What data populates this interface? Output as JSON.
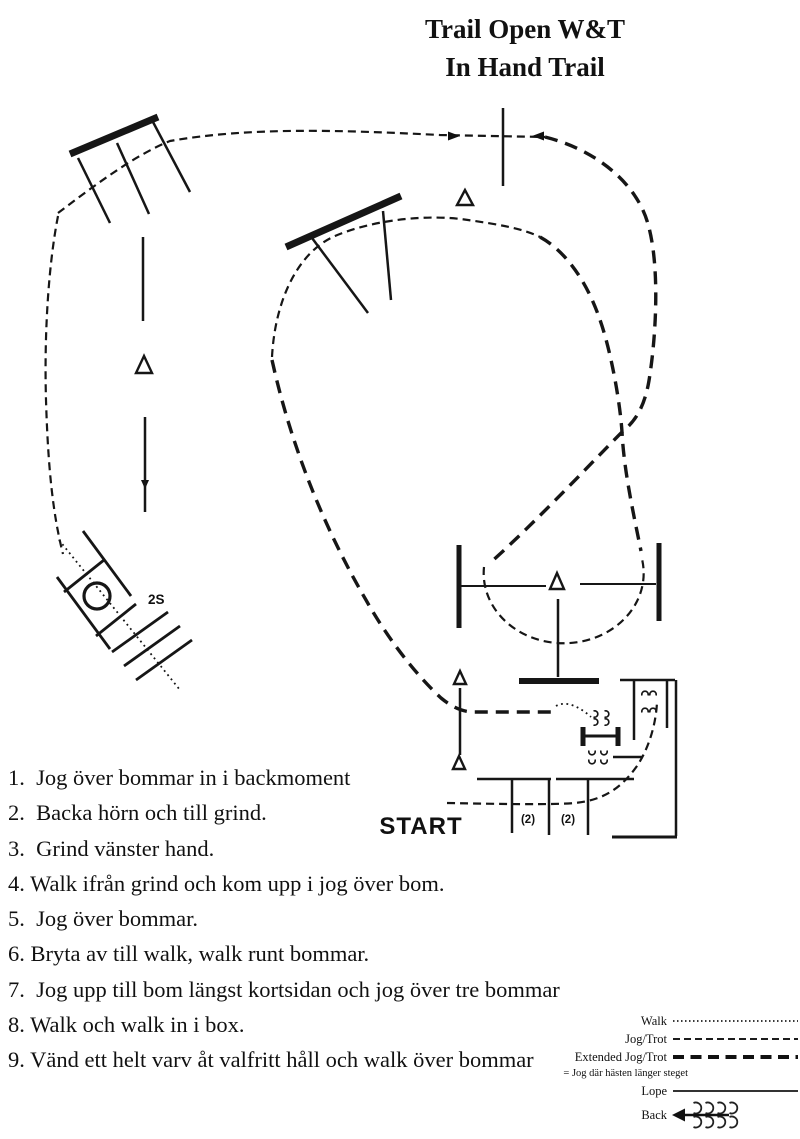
{
  "title": {
    "line1": "Trail Open W&T",
    "line2": "In Hand Trail"
  },
  "course": {
    "start_label": "START",
    "station_label": "2S",
    "pole_spacing_labels": [
      "(2)",
      "(2)"
    ]
  },
  "instructions": [
    "1.  Jog över bommar in i backmoment",
    "2.  Backa hörn och till grind.",
    "3.  Grind vänster hand.",
    "4. Walk ifrån grind och kom upp i jog över bom.",
    "5.  Jog över bommar.",
    "6. Bryta av till walk, walk runt bommar.",
    "7.  Jog upp till bom längst kortsidan och jog över tre bommar",
    "8. Walk och walk in i box.",
    "9. Vänd ett helt varv åt valfritt håll och walk över bommar"
  ],
  "legend": {
    "items": [
      {
        "label": "Walk",
        "line_style": "dotted"
      },
      {
        "label": "Jog/Trot",
        "line_style": "dashed"
      },
      {
        "label": "Extended Jog/Trot",
        "line_style": "heavy-dashed"
      },
      {
        "label": "Lope",
        "line_style": "solid"
      },
      {
        "label": "Back",
        "line_style": "back-arrow"
      }
    ],
    "note": "= Jog där hästen länger steget"
  },
  "colors": {
    "ink": "#111111",
    "background": "#ffffff"
  }
}
